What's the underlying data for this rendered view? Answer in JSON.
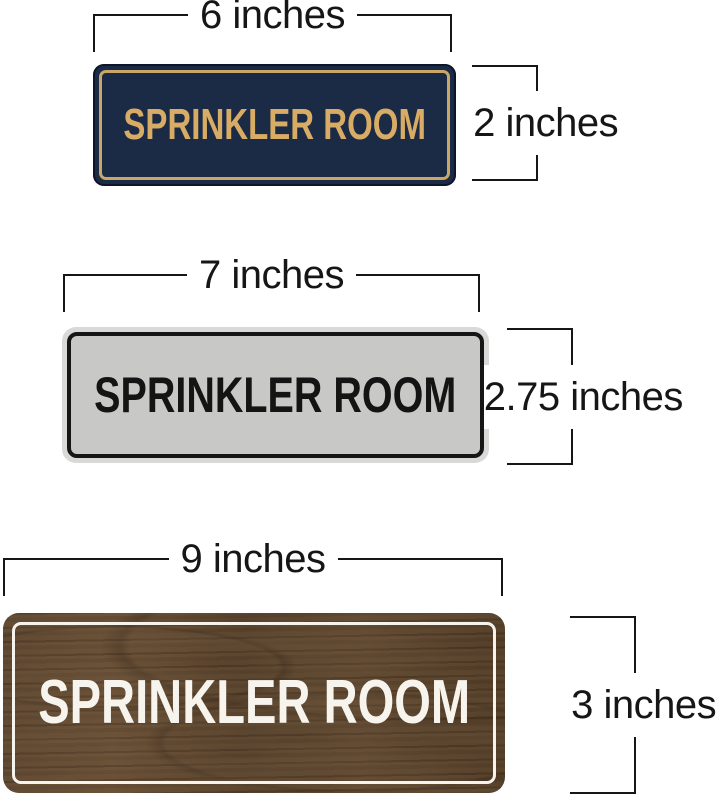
{
  "image": {
    "background": "#ffffff",
    "dimension_line_color": "#161616"
  },
  "signs": [
    {
      "style": "navy-gold",
      "label": "SPRINKLER ROOM",
      "width_label": "6 inches",
      "height_label": "2 inches",
      "colors": {
        "background": "#1c2b45",
        "border": "#caa768",
        "text": "#d9ac66"
      }
    },
    {
      "style": "silver-black",
      "label": "SPRINKLER ROOM",
      "width_label": "7 inches",
      "height_label": "2.75 inches",
      "colors": {
        "rim": "#d9d9d7",
        "background": "#c8c8c6",
        "border": "#161616",
        "text": "#141414"
      }
    },
    {
      "style": "walnut-white",
      "label": "SPRINKLER ROOM",
      "width_label": "9 inches",
      "height_label": "3 inches",
      "colors": {
        "background": "#55402a",
        "border": "#f6f3ec",
        "text": "#f7f4ee"
      }
    }
  ]
}
